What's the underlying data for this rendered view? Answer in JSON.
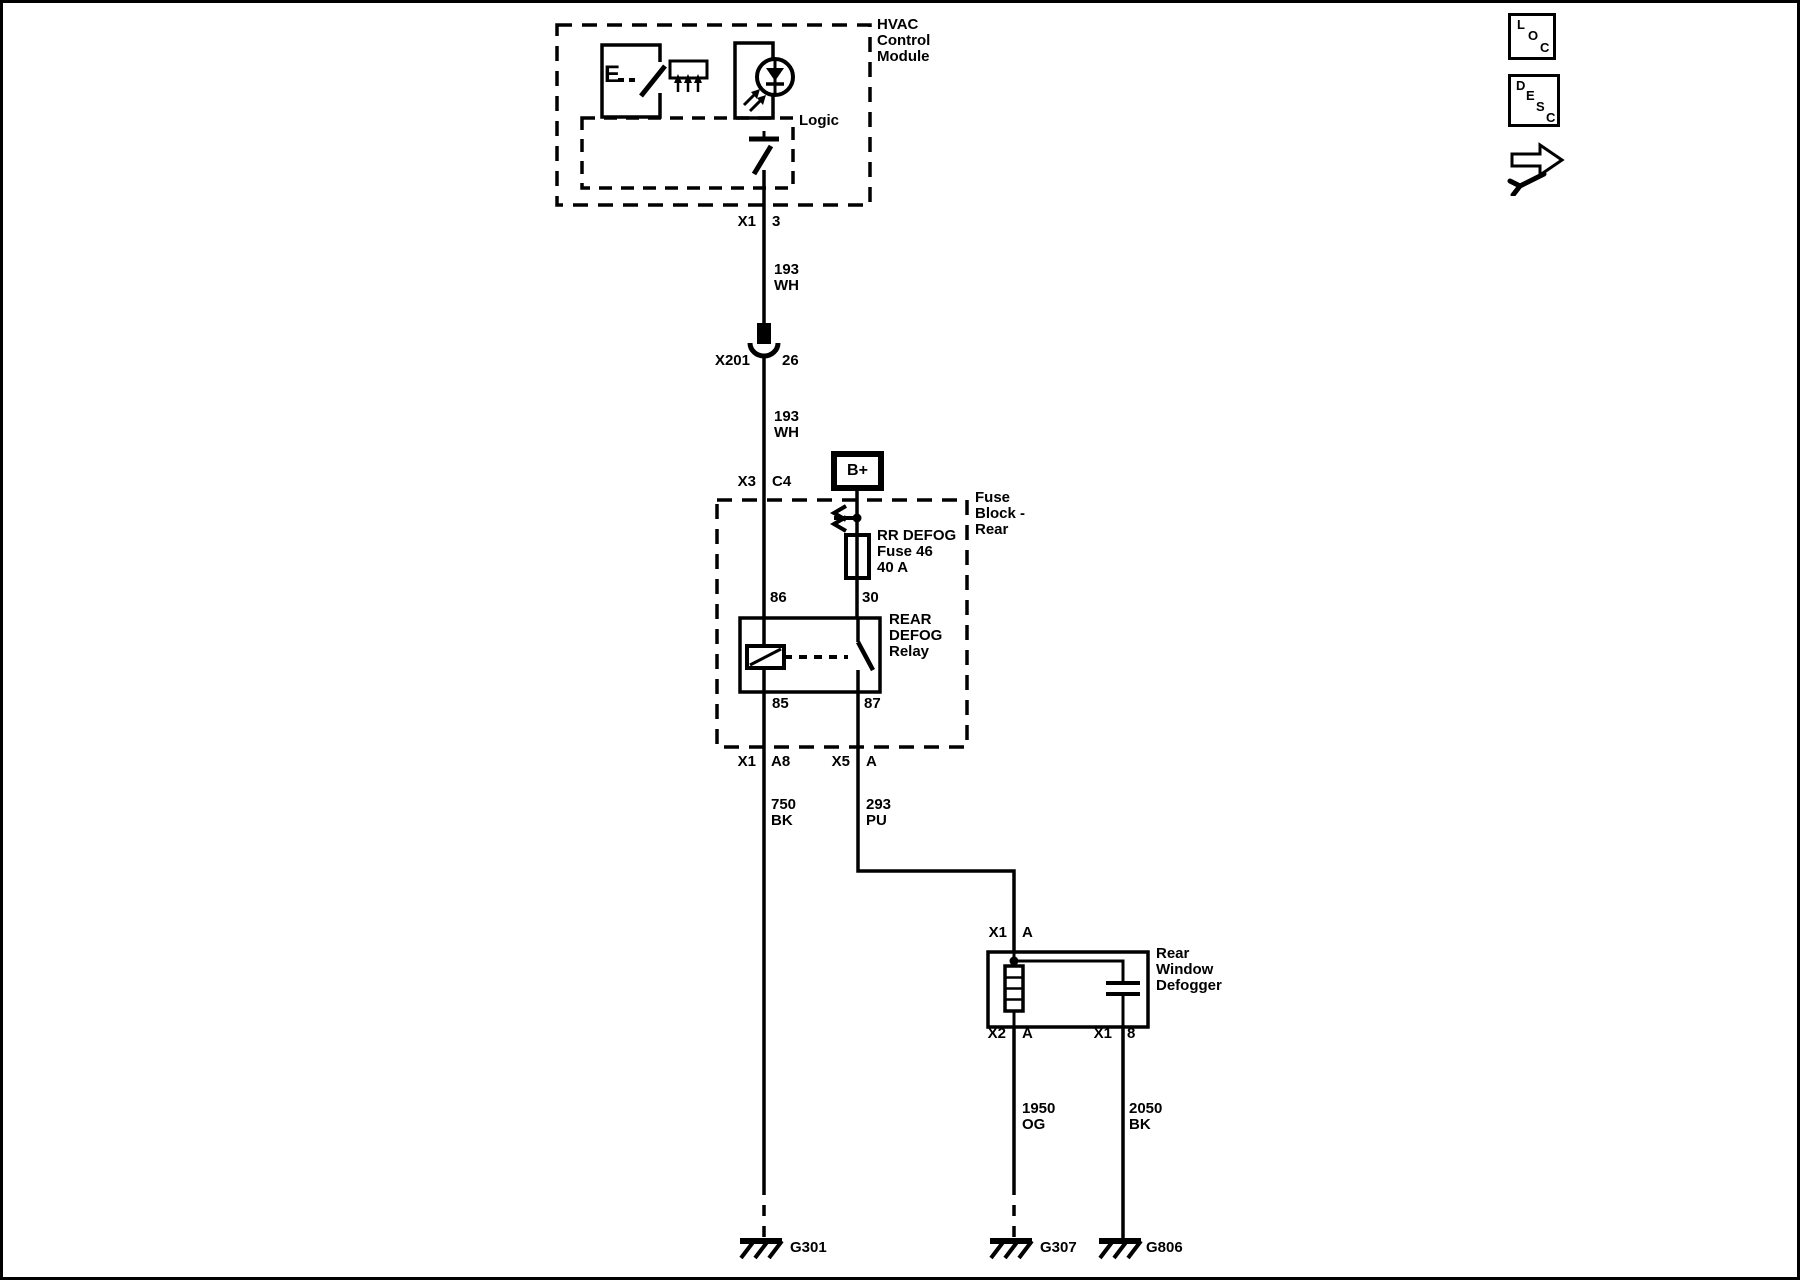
{
  "colors": {
    "ink": "#000000",
    "paper": "#ffffff"
  },
  "header_icons": {
    "loc": [
      "L",
      "O",
      "C"
    ],
    "desc": [
      "D",
      "E",
      "S",
      "C"
    ]
  },
  "hvac_module": {
    "label": [
      "HVAC",
      "Control",
      "Module"
    ],
    "logic_label": "Logic",
    "switch_letter": "E"
  },
  "power": {
    "bplus": "B+"
  },
  "connectors": {
    "x1_3": {
      "name": "X1",
      "pin": "3"
    },
    "x201_26": {
      "name": "X201",
      "pin": "26"
    },
    "x3_c4": {
      "name": "X3",
      "pin": "C4"
    },
    "x1_a8": {
      "name": "X1",
      "pin": "A8"
    },
    "x5_a": {
      "name": "X5",
      "pin": "A"
    },
    "x1_a_defogger": {
      "name": "X1",
      "pin": "A"
    },
    "x2_a": {
      "name": "X2",
      "pin": "A"
    },
    "x1_8": {
      "name": "X1",
      "pin": "8"
    }
  },
  "wires": {
    "w193_upper": [
      "193",
      "WH"
    ],
    "w193_lower": [
      "193",
      "WH"
    ],
    "w750": [
      "750",
      "BK"
    ],
    "w293": [
      "293",
      "PU"
    ],
    "w1950": [
      "1950",
      "OG"
    ],
    "w2050": [
      "2050",
      "BK"
    ]
  },
  "fuse_block": {
    "label": [
      "Fuse",
      "Block -",
      "Rear"
    ],
    "fuse_label": [
      "RR DEFOG",
      "Fuse 46",
      "40 A"
    ],
    "relay_label": [
      "REAR",
      "DEFOG",
      "Relay"
    ],
    "relay_pins": {
      "p86": "86",
      "p30": "30",
      "p85": "85",
      "p87": "87"
    }
  },
  "defogger": {
    "label": [
      "Rear",
      "Window",
      "Defogger"
    ]
  },
  "grounds": {
    "g301": "G301",
    "g307": "G307",
    "g806": "G806"
  }
}
